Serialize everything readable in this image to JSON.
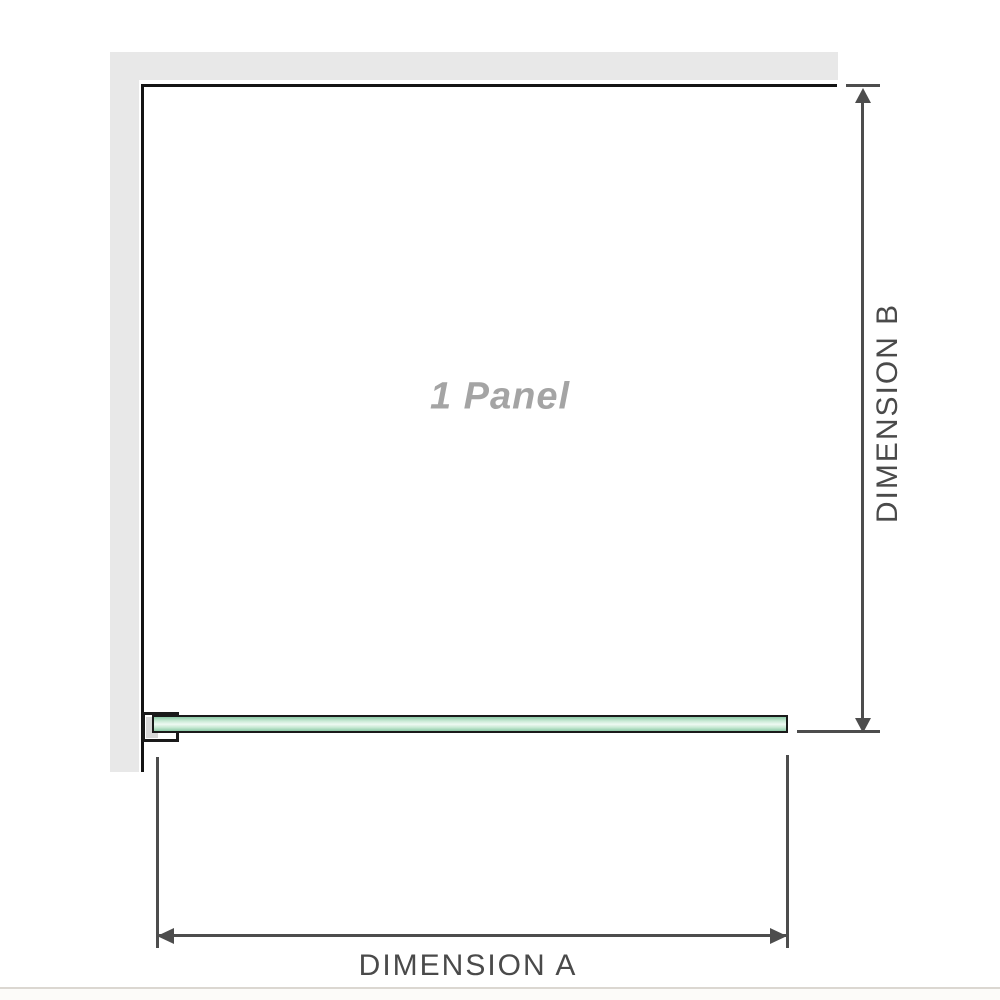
{
  "diagram": {
    "panel_label": "1 Panel",
    "dimension_a_label": "DIMENSION A",
    "dimension_b_label": "DIMENSION B"
  },
  "colors": {
    "background": "#ffffff",
    "wall_fill": "#e8e8e8",
    "frame_stroke": "#141414",
    "dimension_stroke": "#4d4d4d",
    "dimension_text": "#4a4a4a",
    "panel_label_text": "#a4a4a4",
    "glass_border": "#1a1a1a",
    "glass_green_edge": "#8ccaa7",
    "glass_green_mid": "#c9ead5",
    "glass_green_light": "#eef9f2",
    "bracket_inner_fill": "#d8d8d8",
    "footer_rule": "#dbd7d1",
    "footer_background": "#fcfbf9"
  }
}
